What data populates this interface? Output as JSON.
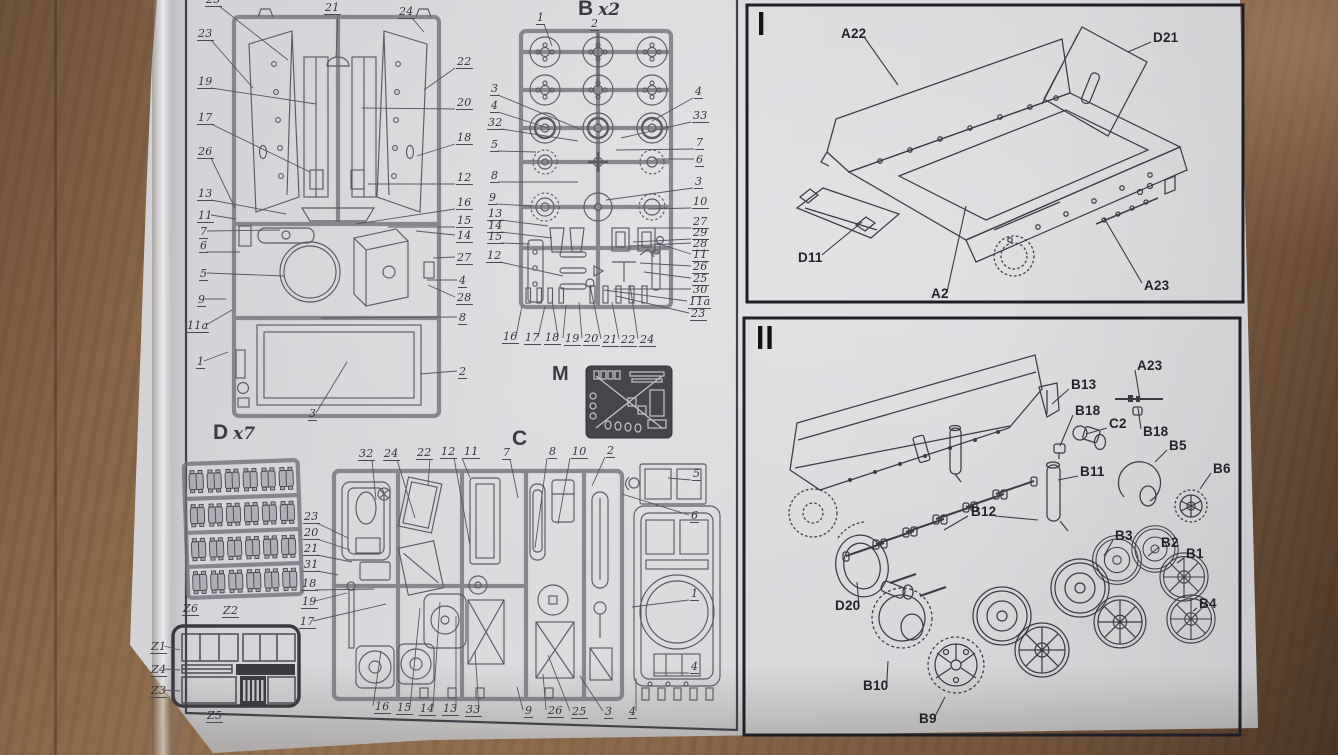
{
  "photo": {
    "wood_color": "#8a6748",
    "paper_color": "#d8d8db",
    "diagram_line_color": "#5a5a62",
    "assembly_line_color": "#3b3b42",
    "panel_border_color": "#1f1f25",
    "label_color": "#34343c"
  },
  "left_page": {
    "sprue_a": {
      "labels": [
        {
          "t": "25",
          "x": 205,
          "y": -6,
          "lx": 288,
          "ly": 60
        },
        {
          "t": "21",
          "x": 324,
          "y": 2,
          "lx": 336,
          "ly": 58
        },
        {
          "t": "24",
          "x": 398,
          "y": 6,
          "lx": 424,
          "ly": 32
        },
        {
          "t": "23",
          "x": 197,
          "y": 28,
          "lx": 253,
          "ly": 88
        },
        {
          "t": "19",
          "x": 197,
          "y": 76,
          "lx": 316,
          "ly": 104
        },
        {
          "t": "17",
          "x": 197,
          "y": 112,
          "lx": 310,
          "ly": 172
        },
        {
          "t": "26",
          "x": 197,
          "y": 146,
          "lx": 235,
          "ly": 208
        },
        {
          "t": "13",
          "x": 197,
          "y": 188,
          "lx": 286,
          "ly": 214
        },
        {
          "t": "11",
          "x": 197,
          "y": 210,
          "lx": 236,
          "ly": 219
        },
        {
          "t": "7",
          "x": 199,
          "y": 226,
          "lx": 280,
          "ly": 230
        },
        {
          "t": "6",
          "x": 199,
          "y": 240,
          "lx": 240,
          "ly": 252
        },
        {
          "t": "5",
          "x": 199,
          "y": 268,
          "lx": 284,
          "ly": 276
        },
        {
          "t": "9",
          "x": 197,
          "y": 294,
          "lx": 226,
          "ly": 299
        },
        {
          "t": "11a",
          "x": 186,
          "y": 320,
          "lx": 232,
          "ly": 310
        },
        {
          "t": "1",
          "x": 196,
          "y": 356,
          "lx": 228,
          "ly": 352
        },
        {
          "t": "22",
          "x": 456,
          "y": 56,
          "lx": 424,
          "ly": 90
        },
        {
          "t": "20",
          "x": 456,
          "y": 97,
          "lx": 362,
          "ly": 108
        },
        {
          "t": "18",
          "x": 456,
          "y": 132,
          "lx": 417,
          "ly": 156
        },
        {
          "t": "12",
          "x": 456,
          "y": 172,
          "lx": 368,
          "ly": 184
        },
        {
          "t": "16",
          "x": 456,
          "y": 197,
          "lx": 356,
          "ly": 224
        },
        {
          "t": "15",
          "x": 456,
          "y": 215,
          "lx": 388,
          "ly": 227
        },
        {
          "t": "14",
          "x": 456,
          "y": 230,
          "lx": 416,
          "ly": 231
        },
        {
          "t": "27",
          "x": 456,
          "y": 252,
          "lx": 433,
          "ly": 258
        },
        {
          "t": "4",
          "x": 458,
          "y": 275,
          "lx": 427,
          "ly": 280
        },
        {
          "t": "28",
          "x": 456,
          "y": 292,
          "lx": 428,
          "ly": 285
        },
        {
          "t": "8",
          "x": 458,
          "y": 312,
          "lx": 321,
          "ly": 318
        },
        {
          "t": "2",
          "x": 458,
          "y": 366,
          "lx": 420,
          "ly": 374
        },
        {
          "t": "3",
          "x": 308,
          "y": 408,
          "lx": 347,
          "ly": 362
        }
      ]
    },
    "sprue_b": {
      "title": "B",
      "mult": "x2",
      "labels": [
        {
          "t": "1",
          "x": 536,
          "y": 12,
          "lx": 552,
          "ly": 46
        },
        {
          "t": "2",
          "x": 590,
          "y": 18,
          "lx": 598,
          "ly": 88
        },
        {
          "t": "3",
          "x": 490,
          "y": 83,
          "lx": 582,
          "ly": 130
        },
        {
          "t": "4",
          "x": 490,
          "y": 100,
          "lx": 548,
          "ly": 128
        },
        {
          "t": "32",
          "x": 487,
          "y": 117,
          "lx": 578,
          "ly": 141
        },
        {
          "t": "5",
          "x": 490,
          "y": 139,
          "lx": 536,
          "ly": 152
        },
        {
          "t": "8",
          "x": 490,
          "y": 170,
          "lx": 578,
          "ly": 182
        },
        {
          "t": "9",
          "x": 488,
          "y": 192,
          "lx": 532,
          "ly": 206
        },
        {
          "t": "13",
          "x": 487,
          "y": 208,
          "lx": 548,
          "ly": 226
        },
        {
          "t": "14",
          "x": 487,
          "y": 220,
          "lx": 552,
          "ly": 238
        },
        {
          "t": "15",
          "x": 487,
          "y": 231,
          "lx": 530,
          "ly": 244
        },
        {
          "t": "12",
          "x": 486,
          "y": 250,
          "lx": 563,
          "ly": 276
        },
        {
          "t": "4",
          "x": 694,
          "y": 86,
          "lx": 652,
          "ly": 121
        },
        {
          "t": "33",
          "x": 692,
          "y": 110,
          "lx": 621,
          "ly": 138
        },
        {
          "t": "7",
          "x": 695,
          "y": 137,
          "lx": 616,
          "ly": 150
        },
        {
          "t": "6",
          "x": 695,
          "y": 154,
          "lx": 654,
          "ly": 159
        },
        {
          "t": "3",
          "x": 694,
          "y": 176,
          "lx": 606,
          "ly": 200
        },
        {
          "t": "10",
          "x": 692,
          "y": 196,
          "lx": 648,
          "ly": 209
        },
        {
          "t": "27",
          "x": 692,
          "y": 216,
          "lx": 654,
          "ly": 228
        },
        {
          "t": "29",
          "x": 692,
          "y": 227,
          "lx": 633,
          "ly": 242
        },
        {
          "t": "28",
          "x": 692,
          "y": 238,
          "lx": 629,
          "ly": 246
        },
        {
          "t": "11",
          "x": 692,
          "y": 249,
          "lx": 656,
          "ly": 243
        },
        {
          "t": "26",
          "x": 692,
          "y": 261,
          "lx": 640,
          "ly": 263
        },
        {
          "t": "25",
          "x": 692,
          "y": 273,
          "lx": 644,
          "ly": 272
        },
        {
          "t": "30",
          "x": 692,
          "y": 284,
          "lx": 614,
          "ly": 289
        },
        {
          "t": "11a",
          "x": 688,
          "y": 296,
          "lx": 604,
          "ly": 290
        },
        {
          "t": "23",
          "x": 690,
          "y": 308,
          "lx": 616,
          "ly": 296
        },
        {
          "t": "16",
          "x": 502,
          "y": 331,
          "lx": 522,
          "ly": 306
        },
        {
          "t": "17",
          "x": 524,
          "y": 332,
          "lx": 545,
          "ly": 306
        },
        {
          "t": "18",
          "x": 544,
          "y": 332,
          "lx": 552,
          "ly": 300
        },
        {
          "t": "19",
          "x": 564,
          "y": 333,
          "lx": 566,
          "ly": 305
        },
        {
          "t": "20",
          "x": 583,
          "y": 333,
          "lx": 579,
          "ly": 302
        },
        {
          "t": "21",
          "x": 602,
          "y": 334,
          "lx": 590,
          "ly": 285
        },
        {
          "t": "22",
          "x": 620,
          "y": 334,
          "lx": 612,
          "ly": 302
        },
        {
          "t": "24",
          "x": 639,
          "y": 334,
          "lx": 630,
          "ly": 285
        }
      ]
    },
    "sprue_c": {
      "title": "C",
      "labels": [
        {
          "t": "32",
          "x": 358,
          "y": 448,
          "lx": 376,
          "ly": 500
        },
        {
          "t": "24",
          "x": 383,
          "y": 448,
          "lx": 415,
          "ly": 518
        },
        {
          "t": "22",
          "x": 416,
          "y": 447,
          "lx": 428,
          "ly": 486
        },
        {
          "t": "12",
          "x": 440,
          "y": 446,
          "lx": 470,
          "ly": 545
        },
        {
          "t": "11",
          "x": 463,
          "y": 446,
          "lx": 470,
          "ly": 478
        },
        {
          "t": "7",
          "x": 502,
          "y": 447,
          "lx": 518,
          "ly": 498
        },
        {
          "t": "8",
          "x": 548,
          "y": 446,
          "lx": 535,
          "ly": 548
        },
        {
          "t": "10",
          "x": 571,
          "y": 446,
          "lx": 558,
          "ly": 524
        },
        {
          "t": "2",
          "x": 606,
          "y": 445,
          "lx": 592,
          "ly": 486
        },
        {
          "t": "5",
          "x": 692,
          "y": 468,
          "lx": 668,
          "ly": 478
        },
        {
          "t": "6",
          "x": 690,
          "y": 510,
          "lx": 622,
          "ly": 494
        },
        {
          "t": "23",
          "x": 303,
          "y": 511,
          "lx": 348,
          "ly": 538
        },
        {
          "t": "20",
          "x": 303,
          "y": 527,
          "lx": 350,
          "ly": 550
        },
        {
          "t": "21",
          "x": 303,
          "y": 543,
          "lx": 352,
          "ly": 562
        },
        {
          "t": "31",
          "x": 303,
          "y": 559,
          "lx": 338,
          "ly": 575
        },
        {
          "t": "18",
          "x": 301,
          "y": 578,
          "lx": 374,
          "ly": 589
        },
        {
          "t": "19",
          "x": 301,
          "y": 596,
          "lx": 347,
          "ly": 593
        },
        {
          "t": "17",
          "x": 299,
          "y": 616,
          "lx": 386,
          "ly": 604
        },
        {
          "t": "16",
          "x": 374,
          "y": 701,
          "lx": 381,
          "ly": 651
        },
        {
          "t": "15",
          "x": 396,
          "y": 702,
          "lx": 420,
          "ly": 608
        },
        {
          "t": "14",
          "x": 419,
          "y": 703,
          "lx": 440,
          "ly": 602
        },
        {
          "t": "13",
          "x": 442,
          "y": 703,
          "lx": 456,
          "ly": 616
        },
        {
          "t": "33",
          "x": 465,
          "y": 704,
          "lx": 475,
          "ly": 651
        },
        {
          "t": "9",
          "x": 524,
          "y": 705,
          "lx": 517,
          "ly": 687
        },
        {
          "t": "26",
          "x": 547,
          "y": 705,
          "lx": 543,
          "ly": 674
        },
        {
          "t": "25",
          "x": 571,
          "y": 706,
          "lx": 548,
          "ly": 655
        },
        {
          "t": "3",
          "x": 604,
          "y": 706,
          "lx": 580,
          "ly": 676
        },
        {
          "t": "4",
          "x": 628,
          "y": 706,
          "lx": 636,
          "ly": 678
        },
        {
          "t": "1",
          "x": 690,
          "y": 588,
          "lx": 632,
          "ly": 607
        },
        {
          "t": "4",
          "x": 690,
          "y": 661,
          "lx": 654,
          "ly": 673
        }
      ]
    },
    "sprue_d": {
      "title": "D",
      "mult": "x7"
    },
    "etch_m": {
      "title": "M"
    },
    "z_sheet": {
      "labels": [
        {
          "t": "Z6",
          "x": 182,
          "y": 603
        },
        {
          "t": "Z2",
          "x": 222,
          "y": 605
        },
        {
          "t": "Z1",
          "x": 150,
          "y": 641,
          "lx": 180,
          "ly": 650
        },
        {
          "t": "Z4",
          "x": 150,
          "y": 664,
          "lx": 180,
          "ly": 670
        },
        {
          "t": "Z3",
          "x": 150,
          "y": 685,
          "lx": 180,
          "ly": 691
        },
        {
          "t": "Z5",
          "x": 206,
          "y": 710
        }
      ]
    }
  },
  "steps": {
    "step1": {
      "numeral": "I",
      "labels": [
        {
          "t": "A22",
          "x": 840,
          "y": 26,
          "lx": 898,
          "ly": 85
        },
        {
          "t": "D21",
          "x": 1152,
          "y": 30,
          "lx": 1128,
          "ly": 52
        },
        {
          "t": "D11",
          "x": 797,
          "y": 250,
          "lx": 862,
          "ly": 222
        },
        {
          "t": "A2",
          "x": 930,
          "y": 286,
          "lx": 966,
          "ly": 206
        },
        {
          "t": "A23",
          "x": 1143,
          "y": 278,
          "lx": 1104,
          "ly": 218
        }
      ]
    },
    "step2": {
      "numeral": "II",
      "labels": [
        {
          "t": "A23",
          "x": 1136,
          "y": 358,
          "lx": 1140,
          "ly": 400
        },
        {
          "t": "B13",
          "x": 1070,
          "y": 377,
          "lx": 1052,
          "ly": 404
        },
        {
          "t": "B18",
          "x": 1074,
          "y": 403,
          "lx": 1060,
          "ly": 446
        },
        {
          "t": "C2",
          "x": 1108,
          "y": 416,
          "lx": 1086,
          "ly": 434
        },
        {
          "t": "B18",
          "x": 1142,
          "y": 424,
          "lx": 1138,
          "ly": 408
        },
        {
          "t": "B5",
          "x": 1168,
          "y": 438,
          "lx": 1155,
          "ly": 462
        },
        {
          "t": "B6",
          "x": 1212,
          "y": 461,
          "lx": 1200,
          "ly": 489
        },
        {
          "t": "B11",
          "x": 1079,
          "y": 464,
          "lx": 1058,
          "ly": 480
        },
        {
          "t": "B12",
          "x": 970,
          "y": 504,
          "lx": 1038,
          "ly": 520
        },
        {
          "t": "B3",
          "x": 1114,
          "y": 528,
          "lx": 1104,
          "ly": 556
        },
        {
          "t": "B2",
          "x": 1160,
          "y": 535,
          "lx": 1148,
          "ly": 556
        },
        {
          "t": "B1",
          "x": 1185,
          "y": 546,
          "lx": 1177,
          "ly": 563
        },
        {
          "t": "B4",
          "x": 1198,
          "y": 596,
          "lx": 1193,
          "ly": 611
        },
        {
          "t": "D20",
          "x": 834,
          "y": 598,
          "lx": 857,
          "ly": 582
        },
        {
          "t": "B10",
          "x": 862,
          "y": 678,
          "lx": 888,
          "ly": 661
        },
        {
          "t": "B9",
          "x": 918,
          "y": 711,
          "lx": 945,
          "ly": 697
        }
      ]
    }
  }
}
